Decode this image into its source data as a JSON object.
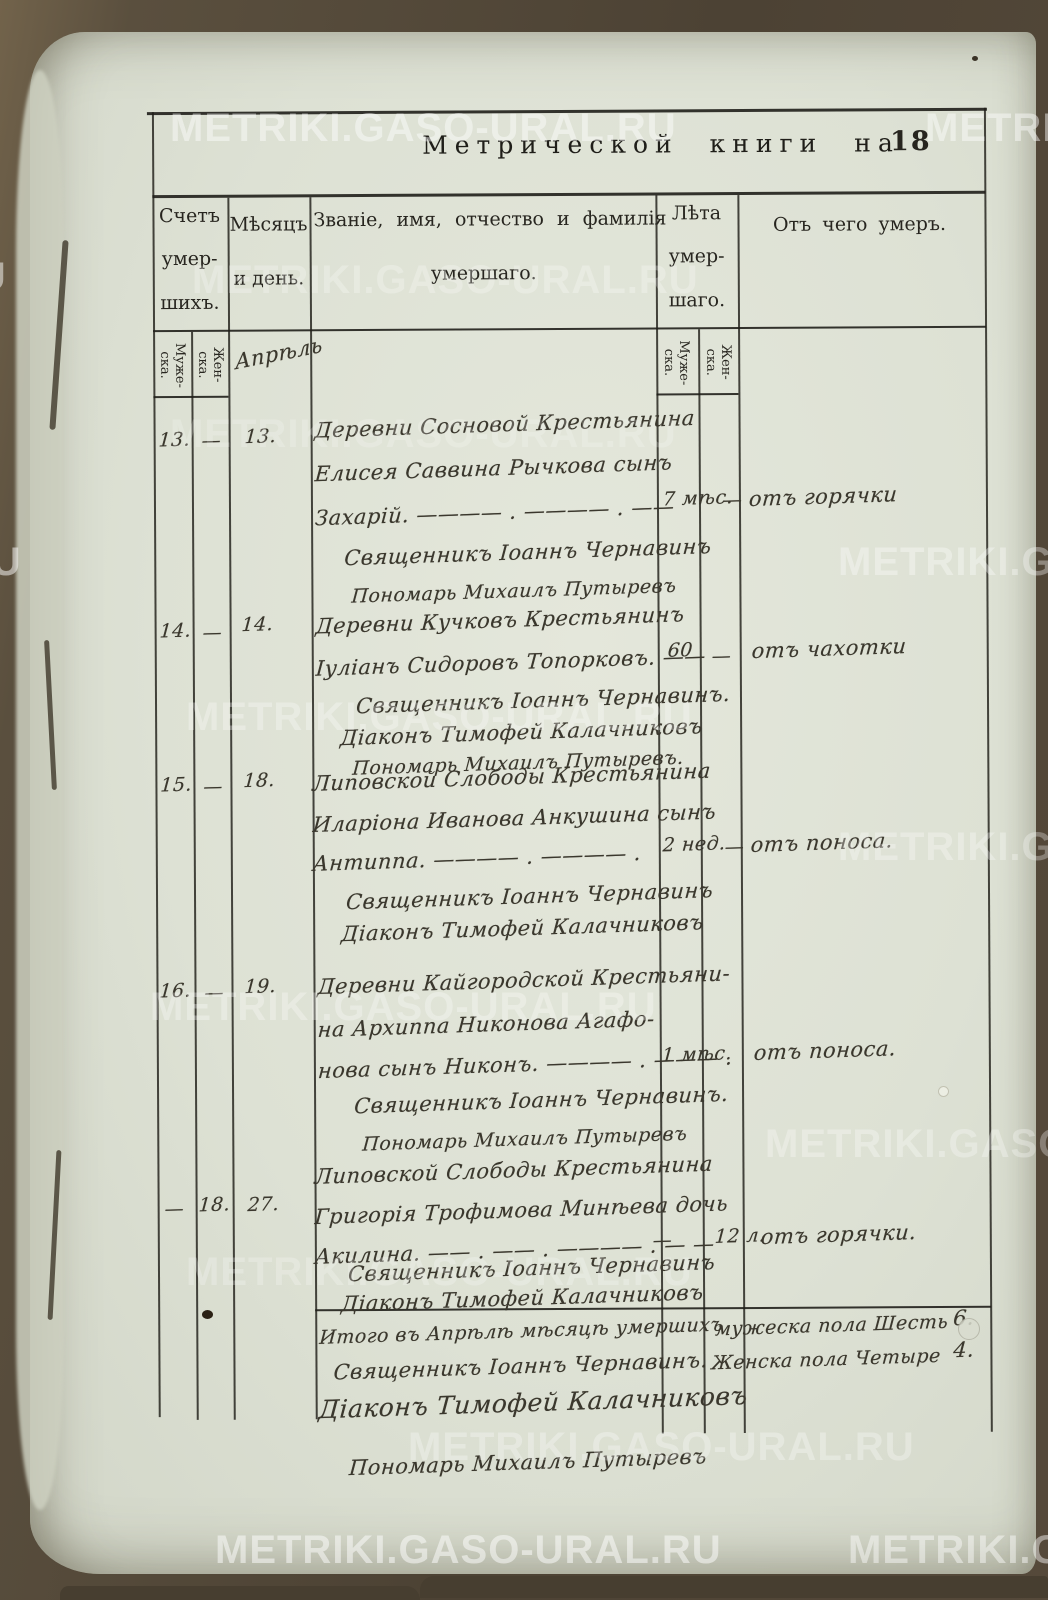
{
  "watermark": {
    "text": "METRIKI.GASO-URAL.RU"
  },
  "title": {
    "prefix": "Метрической книги на",
    "year": "18"
  },
  "table": {
    "header": {
      "count_lines": [
        "Счетъ",
        "умер-",
        "шихъ."
      ],
      "month_lines": [
        "Мѣсяцъ",
        "и день."
      ],
      "name_lines": [
        "Званіе, имя, отчество и фамилія",
        "умершаго."
      ],
      "age_lines": [
        "Лѣта",
        "умер-",
        "шаго."
      ],
      "cause": "Отъ чего умеръ."
    },
    "subheader": {
      "male": "Муже-\nска.",
      "female": "Жен-\nска."
    },
    "month_value": "Апрѣль",
    "rows": [
      {
        "count_male": "13.",
        "count_female": "—",
        "day": "13.",
        "entry_lines": [
          "Деревни Сосновой Крестьянина",
          "Елисея Саввина Рычкова сынъ",
          "Захарій. ———— . ———— . ——"
        ],
        "age_male": "7 мѣс.",
        "age_female": "—",
        "cause": "отъ горячки",
        "signatures": [
          "Священникъ Іоаннъ Чернавинъ",
          "Пономарь Михаилъ Путыревъ"
        ]
      },
      {
        "count_male": "14.",
        "count_female": "—",
        "day": "14.",
        "entry_lines": [
          "Деревни Кучковъ Крестьянинъ",
          "Іуліанъ Сидоровъ Топорковъ. ——"
        ],
        "age_male": "60",
        "age_female": "—",
        "cause": "отъ чахотки",
        "signatures": [
          "Священникъ Іоаннъ Чернавинъ.",
          "Діаконъ Тимофей Калачниковъ",
          "Пономарь Михаилъ Путыревъ."
        ]
      },
      {
        "count_male": "15.",
        "count_female": "—",
        "day": "18.",
        "entry_lines": [
          "Липовской Слободы Крестьянина",
          "Иларіона Иванова Анкушина сынъ",
          "Антиппа. ———— . ———— ."
        ],
        "age_male": "2 нед.",
        "age_female": "—",
        "cause": "отъ поноса.",
        "signatures": [
          "Священникъ Іоаннъ Чернавинъ",
          "Діаконъ Тимофей Калачниковъ"
        ]
      },
      {
        "count_male": "16.",
        "count_female": "—",
        "day": "19.",
        "entry_lines": [
          "Деревни Кайгородской Крестьяни-",
          "на Архиппа Никонова Агафо-",
          "нова сынъ Никонъ. ———— . ——— ."
        ],
        "age_male": "1 мѣс.",
        "age_female": "",
        "cause": "отъ поноса.",
        "signatures": [
          "Священникъ Іоаннъ Чернавинъ.",
          "Пономарь Михаилъ Путыревъ"
        ]
      },
      {
        "count_male": "—",
        "count_female": "18.",
        "day": "27.",
        "entry_lines": [
          "Липовской Слободы Крестьянина",
          "Григорія Трофимова Минѣева дочь",
          "Акилина. —— . —— . ———— . — —"
        ],
        "age_male": "—",
        "age_female": "12 л.",
        "cause": "отъ горячки.",
        "signatures": [
          "Священникъ Іоаннъ Чернавинъ",
          "Діаконъ Тимофей Калачниковъ"
        ]
      }
    ],
    "summary": {
      "line": "Итого въ Апрѣлѣ мѣсяцѣ умершихъ",
      "male_label": "мужеска пола Шесть",
      "male_value": "6.",
      "female_label": "Женска пола Четыре",
      "female_value": "4.",
      "signatures": [
        "Священникъ Іоаннъ Чернавинъ.",
        "Діаконъ Тимофей Калачниковъ"
      ],
      "bottom_signature": "Пономарь Михаилъ Путыревъ"
    }
  }
}
